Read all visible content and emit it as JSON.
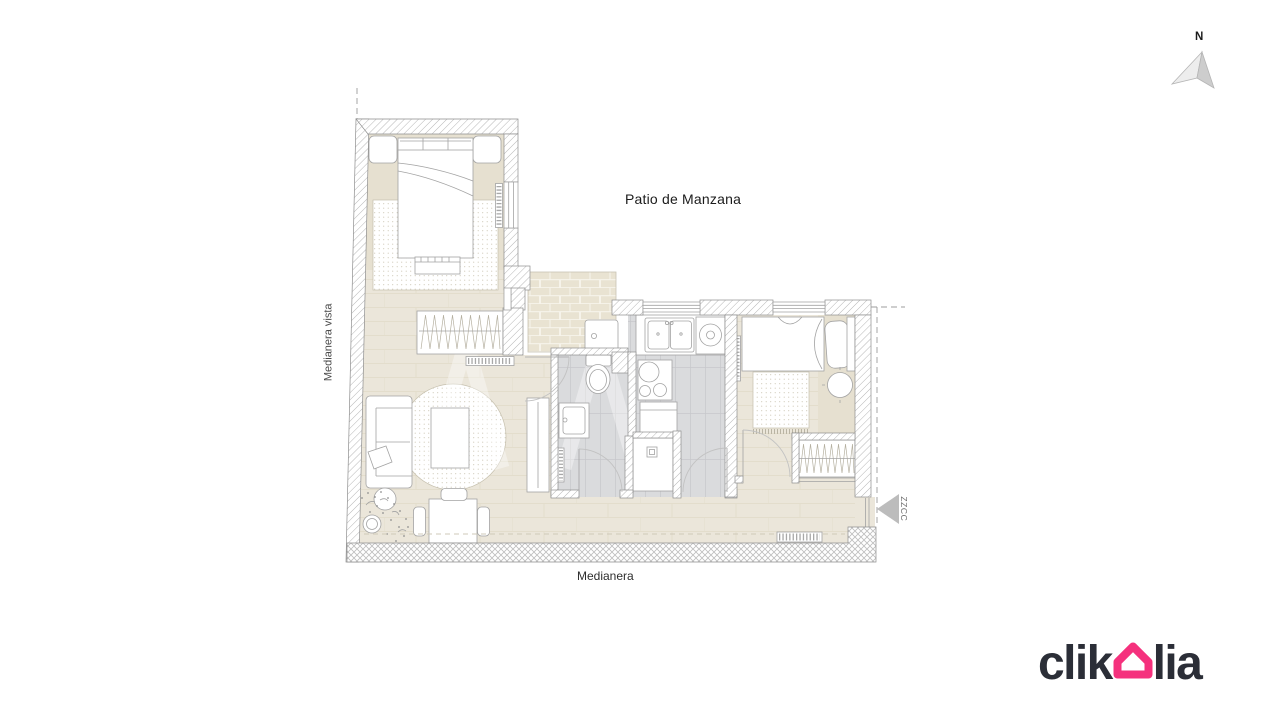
{
  "compass": {
    "label": "N"
  },
  "plan_labels": {
    "patio": "Patio de Manzana",
    "left_boundary": "Medianera vista",
    "bottom_boundary": "Medianera",
    "entry_zone": "ZZCC"
  },
  "logo": {
    "prefix": "clik",
    "suffix": "lia",
    "house_color": "#f5317d",
    "text_color": "#2b2e37"
  },
  "colors": {
    "background": "#ffffff",
    "floor": "#ebe6da",
    "floor_dark": "#e6e0d0",
    "wet_floor": "#dadbdd",
    "terrace": "#e9e3d2",
    "wall_hatch_line": "#b6b6b6",
    "outline": "#8e8e8e",
    "accent_pink": "#f5317d"
  }
}
